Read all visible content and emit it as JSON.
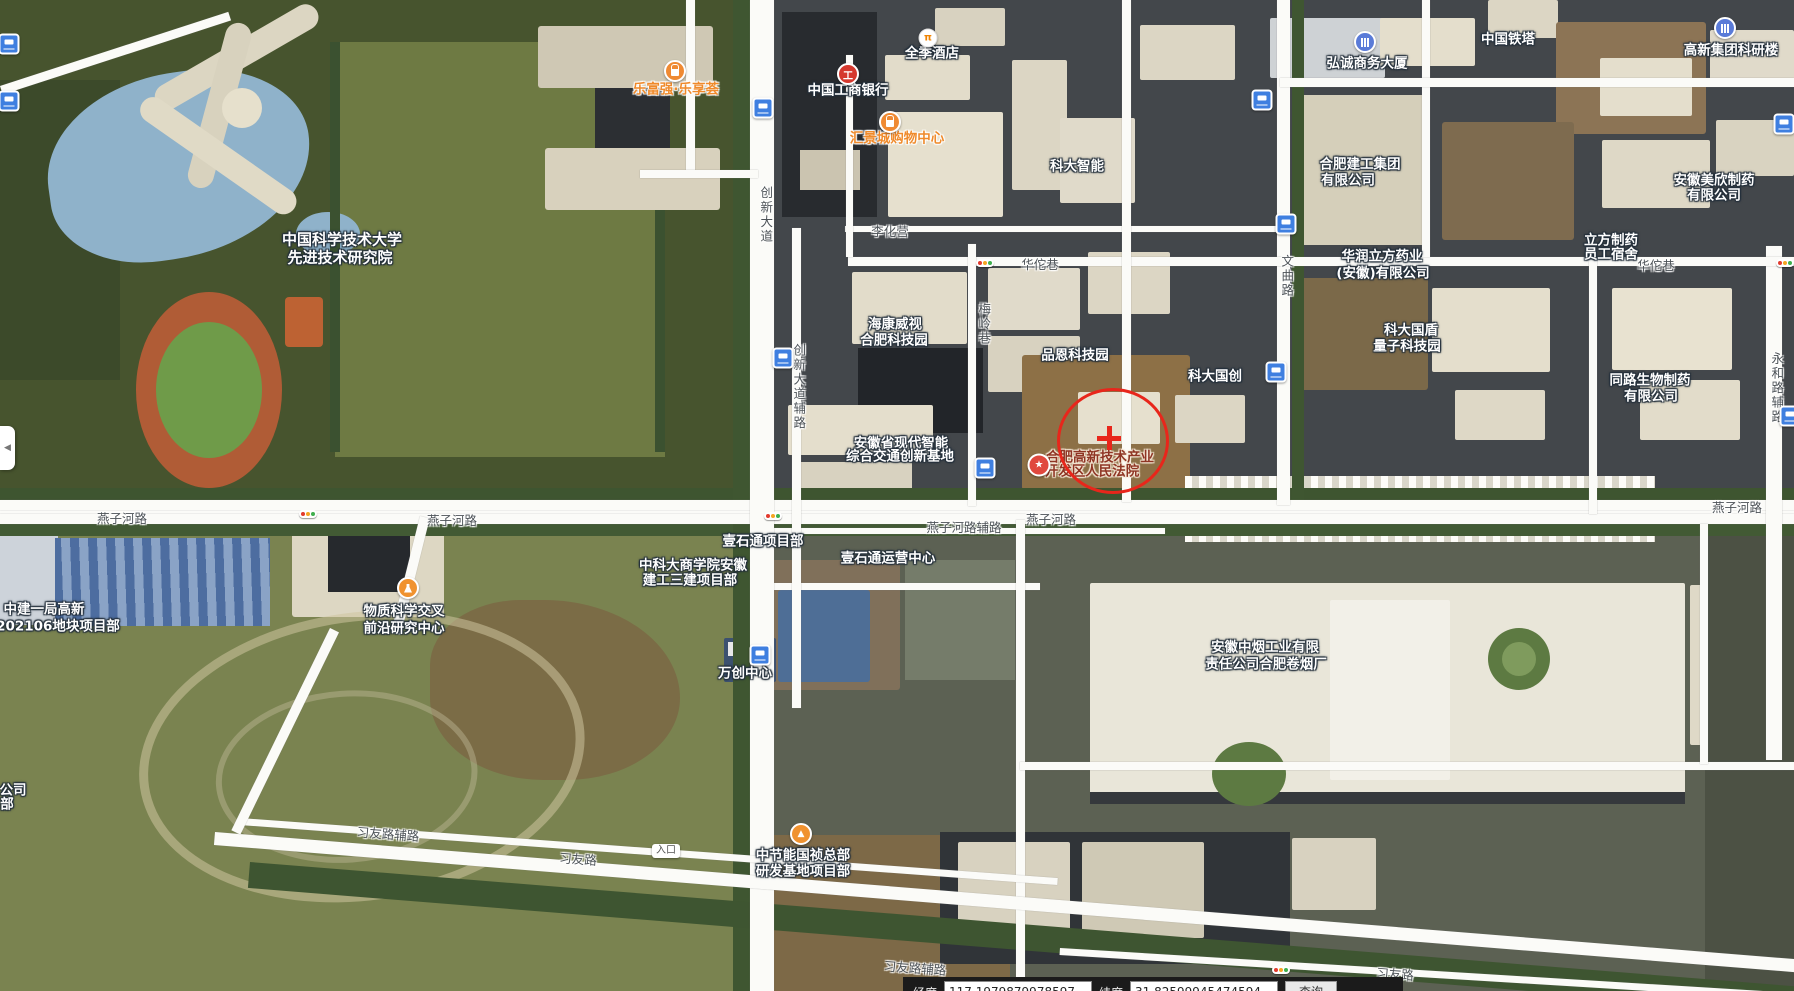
{
  "statusbar": {
    "lng_label": "经度",
    "lng_value": "117.1979879978597",
    "lat_label": "纬度",
    "lat_value": "31.82599945474594",
    "query_label": "查询"
  },
  "collapse_tab": {
    "glyph": "◀"
  },
  "colors": {
    "annotation_red": "#e8261b",
    "poi_orange": "#ef8a33",
    "bus_blue": "#3f7fe0",
    "road_white": "#fbfbf8",
    "bank_red": "#d5382e"
  },
  "annotation": {
    "cx": 1110,
    "cy": 438,
    "rx": 53,
    "ry": 50,
    "cross_x": 1109,
    "cross_y": 438
  },
  "labels": [
    {
      "t": "中国科学技术大学",
      "x": 342,
      "y": 240,
      "k": "p",
      "s": 15
    },
    {
      "t": "先进技术研究院",
      "x": 340,
      "y": 258,
      "k": "p",
      "s": 15
    },
    {
      "t": "乐富强·乐享荟",
      "x": 676,
      "y": 90,
      "k": "o"
    },
    {
      "t": "中国工商银行",
      "x": 848,
      "y": 91,
      "k": "p"
    },
    {
      "t": "全季酒店",
      "x": 932,
      "y": 54,
      "k": "p"
    },
    {
      "t": "汇景城购物中心",
      "x": 897,
      "y": 139,
      "k": "o"
    },
    {
      "t": "科大智能",
      "x": 1077,
      "y": 167,
      "k": "p"
    },
    {
      "t": "弘诚商务大厦",
      "x": 1367,
      "y": 64,
      "k": "p"
    },
    {
      "t": "中国铁塔",
      "x": 1508,
      "y": 40,
      "k": "p"
    },
    {
      "t": "高新集团科研楼",
      "x": 1731,
      "y": 51,
      "k": "p"
    },
    {
      "t": "合肥建工集团",
      "x": 1360,
      "y": 165,
      "k": "p"
    },
    {
      "t": "有限公司",
      "x": 1348,
      "y": 181,
      "k": "p"
    },
    {
      "t": "华润立方药业",
      "x": 1382,
      "y": 257,
      "k": "p"
    },
    {
      "t": "(安徽)有限公司",
      "x": 1383,
      "y": 274,
      "k": "p"
    },
    {
      "t": "安徽美欣制药",
      "x": 1714,
      "y": 181,
      "k": "p"
    },
    {
      "t": "有限公司",
      "x": 1714,
      "y": 196,
      "k": "p"
    },
    {
      "t": "立方制药",
      "x": 1611,
      "y": 241,
      "k": "p"
    },
    {
      "t": "员工宿舍",
      "x": 1611,
      "y": 255,
      "k": "p"
    },
    {
      "t": "海康威视",
      "x": 895,
      "y": 325,
      "k": "p"
    },
    {
      "t": "合肥科技园",
      "x": 894,
      "y": 341,
      "k": "p"
    },
    {
      "t": "品恩科技园",
      "x": 1075,
      "y": 356,
      "k": "p"
    },
    {
      "t": "科大国创",
      "x": 1215,
      "y": 377,
      "k": "p"
    },
    {
      "t": "科大国盾",
      "x": 1411,
      "y": 331,
      "k": "p"
    },
    {
      "t": "量子科技园",
      "x": 1407,
      "y": 347,
      "k": "p"
    },
    {
      "t": "同路生物制药",
      "x": 1650,
      "y": 381,
      "k": "p"
    },
    {
      "t": "有限公司",
      "x": 1651,
      "y": 397,
      "k": "p"
    },
    {
      "t": "安徽省现代智能",
      "x": 901,
      "y": 444,
      "k": "p"
    },
    {
      "t": "综合交通创新基地",
      "x": 900,
      "y": 457,
      "k": "p"
    },
    {
      "t": "合肥高新技术产业",
      "x": 1100,
      "y": 458,
      "k": "c"
    },
    {
      "t": "开发区人民法院",
      "x": 1092,
      "y": 472,
      "k": "c"
    },
    {
      "t": "中科大商学院安徽",
      "x": 693,
      "y": 566,
      "k": "p"
    },
    {
      "t": "建工三建项目部",
      "x": 690,
      "y": 581,
      "k": "p"
    },
    {
      "t": "壹石通项目部",
      "x": 763,
      "y": 542,
      "k": "p"
    },
    {
      "t": "壹石通运营中心",
      "x": 888,
      "y": 559,
      "k": "p"
    },
    {
      "t": "物质科学交叉",
      "x": 404,
      "y": 612,
      "k": "p"
    },
    {
      "t": "前沿研究中心",
      "x": 404,
      "y": 629,
      "k": "p"
    },
    {
      "t": "中建一局高新",
      "x": 44,
      "y": 610,
      "k": "p"
    },
    {
      "t": "202106地块项目部",
      "x": 58,
      "y": 627,
      "k": "p"
    },
    {
      "t": "万创中心",
      "x": 745,
      "y": 674,
      "k": "p"
    },
    {
      "t": "中节能国祯总部",
      "x": 803,
      "y": 856,
      "k": "p"
    },
    {
      "t": "研发基地项目部",
      "x": 803,
      "y": 872,
      "k": "p"
    },
    {
      "t": "安徽中烟工业有限",
      "x": 1265,
      "y": 648,
      "k": "p"
    },
    {
      "t": "责任公司合肥卷烟厂",
      "x": 1266,
      "y": 665,
      "k": "p"
    },
    {
      "t": "公司",
      "x": 13,
      "y": 791,
      "k": "p"
    },
    {
      "t": "部",
      "x": 7,
      "y": 805,
      "k": "p"
    },
    {
      "t": "燕子河路",
      "x": 122,
      "y": 519,
      "k": "r"
    },
    {
      "t": "燕子河路",
      "x": 452,
      "y": 521,
      "k": "r"
    },
    {
      "t": "燕子河路",
      "x": 1051,
      "y": 520,
      "k": "r"
    },
    {
      "t": "燕子河路",
      "x": 1737,
      "y": 508,
      "k": "r"
    },
    {
      "t": "燕子河路辅路",
      "x": 964,
      "y": 528,
      "k": "r"
    },
    {
      "t": "创新大道",
      "x": 765,
      "y": 215,
      "k": "r",
      "v": 1
    },
    {
      "t": "创新大道辅路",
      "x": 798,
      "y": 387,
      "k": "r",
      "v": 1
    },
    {
      "t": "文曲路",
      "x": 1286,
      "y": 276,
      "k": "r",
      "v": 1
    },
    {
      "t": "梅岭巷",
      "x": 983,
      "y": 324,
      "k": "r",
      "v": 1
    },
    {
      "t": "永和路辅路",
      "x": 1776,
      "y": 388,
      "k": "r",
      "v": 1
    },
    {
      "t": "华佗巷",
      "x": 1040,
      "y": 265,
      "k": "r"
    },
    {
      "t": "华佗巷",
      "x": 1656,
      "y": 266,
      "k": "r"
    },
    {
      "t": "李化营",
      "x": 890,
      "y": 232,
      "k": "r"
    },
    {
      "t": "习友路辅路",
      "x": 388,
      "y": 835,
      "k": "r",
      "r": 4
    },
    {
      "t": "习友路",
      "x": 578,
      "y": 860,
      "k": "r",
      "r": 4
    },
    {
      "t": "习友路辅路",
      "x": 915,
      "y": 969,
      "k": "r",
      "r": 4
    },
    {
      "t": "习友路",
      "x": 1395,
      "y": 975,
      "k": "r",
      "r": 4
    },
    {
      "t": "入口",
      "x": 666,
      "y": 851,
      "k": "b"
    }
  ],
  "icons": [
    {
      "n": "bus-stop",
      "k": "bus",
      "x": 763,
      "y": 108
    },
    {
      "n": "bus-stop",
      "k": "bus",
      "x": 1262,
      "y": 100
    },
    {
      "n": "bus-stop",
      "k": "bus",
      "x": 1784,
      "y": 124
    },
    {
      "n": "bus-stop",
      "k": "bus",
      "x": 1286,
      "y": 224
    },
    {
      "n": "bus-stop",
      "k": "bus",
      "x": 783,
      "y": 358
    },
    {
      "n": "bus-stop",
      "k": "bus",
      "x": 1276,
      "y": 372
    },
    {
      "n": "bus-stop",
      "k": "bus",
      "x": 985,
      "y": 468
    },
    {
      "n": "bus-stop",
      "k": "bus",
      "x": 760,
      "y": 655
    },
    {
      "n": "bus-stop",
      "k": "bus",
      "x": 9,
      "y": 44
    },
    {
      "n": "bus-stop",
      "k": "bus",
      "x": 9,
      "y": 101
    },
    {
      "n": "bus-stop",
      "k": "bus",
      "x": 1790,
      "y": 416
    },
    {
      "n": "icbc-bank",
      "k": "bank",
      "x": 848,
      "y": 74,
      "g": "工"
    },
    {
      "n": "shopping-mall",
      "k": "shop",
      "x": 675,
      "y": 71
    },
    {
      "n": "shopping-mall",
      "k": "shop",
      "x": 890,
      "y": 122
    },
    {
      "n": "hotel",
      "k": "hotel",
      "x": 928,
      "y": 38,
      "g": "π"
    },
    {
      "n": "office-building",
      "k": "bldg",
      "x": 1365,
      "y": 42
    },
    {
      "n": "office-building",
      "k": "bldg",
      "x": 1725,
      "y": 28
    },
    {
      "n": "court-poi",
      "k": "star",
      "x": 1039,
      "y": 465,
      "g": "★"
    },
    {
      "n": "construction-site",
      "k": "constr",
      "x": 801,
      "y": 834,
      "g": "▲"
    },
    {
      "n": "research-lab",
      "k": "flask",
      "x": 408,
      "y": 588
    },
    {
      "n": "traffic-light",
      "k": "traffic",
      "x": 308,
      "y": 514
    },
    {
      "n": "traffic-light",
      "k": "traffic",
      "x": 773,
      "y": 516
    },
    {
      "n": "traffic-light",
      "k": "traffic",
      "x": 985,
      "y": 263
    },
    {
      "n": "traffic-light",
      "k": "traffic",
      "x": 1785,
      "y": 263
    },
    {
      "n": "traffic-light",
      "k": "traffic",
      "x": 1281,
      "y": 970
    }
  ],
  "satellite": {
    "patches": [
      [
        0,
        0,
        758,
        502,
        "#47542e"
      ],
      [
        335,
        42,
        330,
        415,
        "#6e7a43"
      ],
      [
        0,
        502,
        760,
        489,
        "#7a8350"
      ],
      [
        760,
        0,
        1034,
        502,
        "#43474b"
      ],
      [
        760,
        502,
        1034,
        489,
        "#5c6153"
      ],
      [
        0,
        80,
        120,
        300,
        "#3c4a2a"
      ],
      [
        35,
        92,
        265,
        185,
        "#8fb2ca",
        "55% 45% 60% 40%",
        -8
      ],
      [
        296,
        212,
        64,
        44,
        "#8fb2ca",
        "50%"
      ],
      [
        150,
        92,
        185,
        26,
        "#dcd6c2",
        "13px",
        -30
      ],
      [
        229,
        20,
        26,
        170,
        "#d8d2be",
        "13px",
        15
      ],
      [
        150,
        92,
        185,
        26,
        "#e0dac6",
        "13px",
        35
      ],
      [
        222,
        88,
        40,
        40,
        "#e6e0cc",
        "50%"
      ],
      [
        330,
        42,
        10,
        410,
        "#3b5130"
      ],
      [
        655,
        42,
        10,
        410,
        "#3b5130"
      ],
      [
        136,
        292,
        146,
        196,
        "#b05c36",
        "50%"
      ],
      [
        156,
        322,
        106,
        136,
        "#6f9b49",
        "50%"
      ],
      [
        285,
        297,
        38,
        50,
        "#bd6233",
        "4px"
      ],
      [
        538,
        26,
        175,
        62,
        "#cfc8b4",
        "3px"
      ],
      [
        545,
        148,
        175,
        62,
        "#d8d1bd",
        "3px"
      ],
      [
        595,
        88,
        75,
        60,
        "#2c2f33"
      ],
      [
        782,
        12,
        95,
        205,
        "#282b2f"
      ],
      [
        800,
        150,
        60,
        40,
        "#cbc4b0"
      ],
      [
        885,
        55,
        85,
        45,
        "#e2dcca",
        "2px"
      ],
      [
        888,
        112,
        115,
        105,
        "#e6e0ce",
        "2px"
      ],
      [
        1012,
        60,
        55,
        130,
        "#dcd6c4",
        "2px"
      ],
      [
        1060,
        118,
        75,
        85,
        "#e0daca",
        "2px"
      ],
      [
        935,
        8,
        70,
        38,
        "#d8d2c0",
        "2px"
      ],
      [
        1140,
        25,
        95,
        55,
        "#dcd6c4",
        "2px"
      ],
      [
        1270,
        18,
        115,
        60,
        "#ced2d5",
        "2px"
      ],
      [
        1380,
        18,
        95,
        48,
        "#e4decc",
        "2px"
      ],
      [
        1488,
        0,
        70,
        38,
        "#dcd6c4",
        "2px"
      ],
      [
        1556,
        22,
        150,
        112,
        "#8c7455",
        "3px"
      ],
      [
        1600,
        58,
        92,
        58,
        "#e4decc",
        "2px"
      ],
      [
        1602,
        140,
        108,
        68,
        "#ded8c6",
        "2px"
      ],
      [
        1710,
        30,
        84,
        52,
        "#e0daca",
        "2px"
      ],
      [
        1716,
        120,
        78,
        56,
        "#d9d3c1",
        "2px"
      ],
      [
        1300,
        95,
        125,
        150,
        "#d5cfba",
        "2px"
      ],
      [
        1442,
        122,
        132,
        118,
        "#7e6b4f",
        "3px"
      ],
      [
        1612,
        288,
        120,
        82,
        "#e8e2d0",
        "2px"
      ],
      [
        1640,
        380,
        100,
        60,
        "#e2dcca",
        "2px"
      ],
      [
        1300,
        278,
        128,
        112,
        "#7b6949",
        "3px"
      ],
      [
        1432,
        288,
        118,
        84,
        "#e4decc",
        "2px"
      ],
      [
        1455,
        390,
        90,
        50,
        "#ded8c6",
        "2px"
      ],
      [
        852,
        272,
        115,
        72,
        "#e2dcca",
        "2px"
      ],
      [
        858,
        348,
        125,
        85,
        "#222529"
      ],
      [
        988,
        268,
        92,
        62,
        "#e0daca",
        "2px"
      ],
      [
        1088,
        252,
        82,
        62,
        "#dcd6c4",
        "2px"
      ],
      [
        988,
        336,
        92,
        56,
        "#d8d2c0",
        "2px"
      ],
      [
        1022,
        355,
        168,
        135,
        "#8d7046",
        "3px"
      ],
      [
        1078,
        392,
        82,
        52,
        "#e6e0ce",
        "2px"
      ],
      [
        1175,
        395,
        70,
        48,
        "#dcd6c4",
        "2px"
      ],
      [
        788,
        405,
        145,
        50,
        "#e4decc",
        "2px"
      ],
      [
        792,
        462,
        120,
        30,
        "#d8d2c0",
        "2px"
      ],
      [
        0,
        510,
        58,
        115,
        "#cdd3da",
        "2px"
      ],
      [
        55,
        538,
        215,
        88,
        "",
        "",
        "",
        "blueroof"
      ],
      [
        292,
        505,
        152,
        112,
        "#ddd7c3",
        "3px"
      ],
      [
        328,
        536,
        82,
        56,
        "#26292d"
      ],
      [
        430,
        600,
        250,
        180,
        "#7b6c46",
        "40% 60% 50% 50%"
      ],
      [
        120,
        645,
        430,
        270,
        "",
        "50%",
        -8,
        "ring"
      ],
      [
        210,
        700,
        250,
        160,
        "",
        "50%",
        -4,
        "ring2"
      ],
      [
        770,
        560,
        130,
        130,
        "#80705a",
        "3px"
      ],
      [
        778,
        590,
        92,
        92,
        "#4e6e96",
        "3px"
      ],
      [
        905,
        560,
        110,
        120,
        "#757c6a"
      ],
      [
        724,
        638,
        52,
        44,
        "#3c5170",
        "2px"
      ],
      [
        728,
        642,
        20,
        14,
        "#e8e8ea"
      ],
      [
        1185,
        476,
        470,
        66,
        "",
        "",
        "",
        "stripes"
      ],
      [
        1090,
        583,
        595,
        212,
        "#e9e6d9",
        "2px"
      ],
      [
        1090,
        792,
        595,
        12,
        "#35383c"
      ],
      [
        1330,
        600,
        120,
        180,
        "#f2f0e8",
        "2px"
      ],
      [
        1690,
        585,
        70,
        160,
        "#dfd9c7",
        "2px"
      ],
      [
        1488,
        628,
        62,
        62,
        "#5d7a42",
        "50%"
      ],
      [
        1502,
        642,
        34,
        34,
        "#7f9b5d",
        "50%"
      ],
      [
        1212,
        742,
        74,
        64,
        "#5d7a42",
        "50%"
      ],
      [
        1705,
        520,
        89,
        471,
        "#4c5144"
      ],
      [
        760,
        835,
        250,
        156,
        "#7d6947",
        "3px"
      ],
      [
        940,
        832,
        350,
        132,
        "#303438"
      ],
      [
        958,
        842,
        112,
        92,
        "#d8d2c0",
        "2px"
      ],
      [
        1082,
        842,
        122,
        96,
        "#cfc9b5",
        "2px"
      ],
      [
        1292,
        838,
        84,
        72,
        "#d8d2c0",
        "2px"
      ],
      [
        0,
        488,
        1794,
        13,
        "#3e5530"
      ],
      [
        0,
        524,
        1794,
        12,
        "#425a34"
      ],
      [
        733,
        0,
        17,
        991,
        "#3f5631"
      ],
      [
        1292,
        0,
        12,
        505,
        "#3f5631"
      ],
      [
        250,
        862,
        1560,
        26,
        "#3e5531",
        "",
        4.6
      ]
    ],
    "roads": [
      [
        0,
        500,
        1794,
        24
      ],
      [
        0,
        511,
        1794,
        2
      ],
      [
        755,
        528,
        410,
        6
      ],
      [
        755,
        583,
        285,
        7
      ],
      [
        750,
        0,
        24,
        991
      ],
      [
        792,
        228,
        9,
        480
      ],
      [
        1277,
        0,
        13,
        505
      ],
      [
        1766,
        246,
        16,
        514
      ],
      [
        848,
        257,
        946,
        9
      ],
      [
        845,
        226,
        440,
        6
      ],
      [
        968,
        244,
        8,
        262
      ],
      [
        1122,
        0,
        9,
        502
      ],
      [
        846,
        55,
        7,
        202
      ],
      [
        1422,
        0,
        8,
        257
      ],
      [
        1589,
        260,
        8,
        254
      ],
      [
        686,
        0,
        9,
        176
      ],
      [
        640,
        170,
        118,
        8
      ],
      [
        1280,
        78,
        514,
        9
      ],
      [
        1016,
        520,
        9,
        471
      ],
      [
        1020,
        762,
        774,
        8
      ],
      [
        1700,
        524,
        8,
        240
      ],
      [
        0,
        86,
        240,
        9,
        -18
      ],
      [
        215,
        832,
        1660,
        13,
        4.6
      ],
      [
        240,
        818,
        820,
        7,
        4.2
      ],
      [
        1060,
        948,
        760,
        7,
        3.5
      ],
      [
        420,
        516,
        10,
        120,
        14
      ],
      [
        330,
        628,
        10,
        225,
        26
      ]
    ]
  }
}
